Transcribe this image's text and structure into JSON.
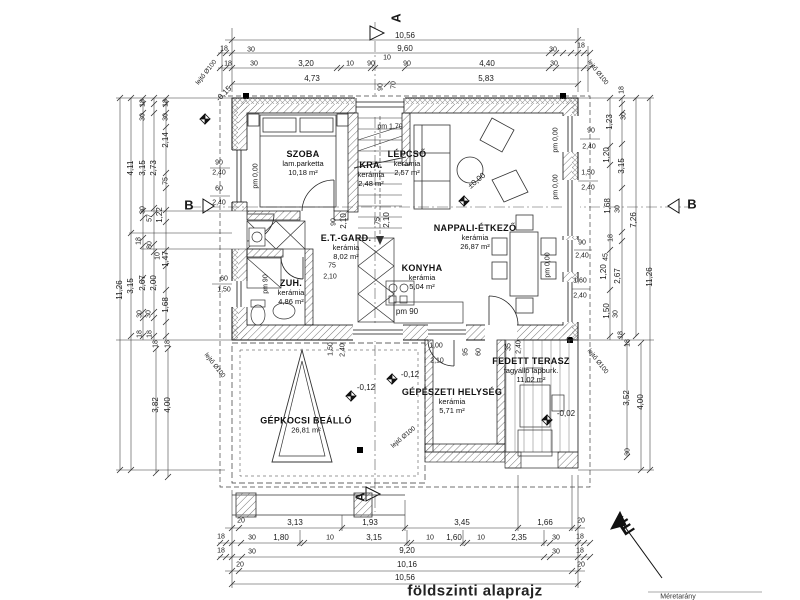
{
  "drawing": {
    "title": "földszinti alaprajz",
    "scale_note": "Méretarány",
    "north_label": "É"
  },
  "rooms": [
    {
      "name": "SZOBA",
      "finish": "lam.parketta",
      "area": "10,18 m²",
      "x": 303,
      "y": 163
    },
    {
      "name": "KRA.",
      "finish": "kerámia",
      "area": "2,48 m²",
      "x": 371,
      "y": 174
    },
    {
      "name": "LÉPCSŐ",
      "finish": "kerámia",
      "area": "2,57 m²",
      "x": 407,
      "y": 163
    },
    {
      "name": "NAPPALI-ÉTKEZŐ",
      "finish": "kerámia",
      "area": "26,87 m²",
      "x": 475,
      "y": 237
    },
    {
      "name": "E.T.-GARD.",
      "finish": "kerámia",
      "area": "8,02 m²",
      "x": 346,
      "y": 247
    },
    {
      "name": "KONYHA",
      "finish": "kerámia",
      "area": "5,04 m²",
      "x": 422,
      "y": 277
    },
    {
      "name": "ZUH.",
      "finish": "kerámia",
      "area": "4,86 m²",
      "x": 291,
      "y": 292
    },
    {
      "name": "GÉPÉSZETI HELYSÉG",
      "finish": "kerámia",
      "area": "5,71 m²",
      "x": 452,
      "y": 401
    },
    {
      "name": "FEDETT TERASZ",
      "finish": "fagyálló lapburk.",
      "area": "11,02 m²",
      "x": 531,
      "y": 370
    },
    {
      "name": "GÉPKOCSI BEÁLLÓ",
      "finish": "",
      "area": "26,81 m²",
      "x": 306,
      "y": 425
    }
  ],
  "labels": [
    {
      "n": "dim-top",
      "t": "10,56",
      "x": 405,
      "y": 36
    },
    {
      "n": "dim-top",
      "t": "18",
      "x": 224,
      "y": 49,
      "s": 7
    },
    {
      "n": "dim-top",
      "t": "30",
      "x": 251,
      "y": 50,
      "s": 7
    },
    {
      "n": "dim-top",
      "t": "9,60",
      "x": 405,
      "y": 49
    },
    {
      "n": "dim-top",
      "t": "10",
      "x": 387,
      "y": 58,
      "s": 7
    },
    {
      "n": "dim-top",
      "t": "30",
      "x": 553,
      "y": 50,
      "s": 7
    },
    {
      "n": "dim-top",
      "t": "18",
      "x": 581,
      "y": 46,
      "s": 7
    },
    {
      "n": "dim-top",
      "t": "18",
      "x": 228,
      "y": 64,
      "s": 7
    },
    {
      "n": "dim-top",
      "t": "30",
      "x": 254,
      "y": 64,
      "s": 7
    },
    {
      "n": "dim-top",
      "t": "3,20",
      "x": 306,
      "y": 64
    },
    {
      "n": "dim-top",
      "t": "10",
      "x": 350,
      "y": 64,
      "s": 7
    },
    {
      "n": "dim-top",
      "t": "90",
      "x": 371,
      "y": 64,
      "s": 7
    },
    {
      "n": "dim-top",
      "t": "90",
      "x": 407,
      "y": 64,
      "s": 7
    },
    {
      "n": "dim-top",
      "t": "4,40",
      "x": 487,
      "y": 64
    },
    {
      "n": "dim-top",
      "t": "30",
      "x": 554,
      "y": 64,
      "s": 7
    },
    {
      "n": "dim-top",
      "t": "4,73",
      "x": 312,
      "y": 79
    },
    {
      "n": "dim-top",
      "t": "5,83",
      "x": 486,
      "y": 79
    },
    {
      "n": "dim-top",
      "t": "90",
      "x": 381,
      "y": 87,
      "r": -90,
      "s": 7
    },
    {
      "n": "dim-top",
      "t": "70",
      "x": 394,
      "y": 85,
      "r": -90,
      "s": 7
    },
    {
      "n": "dim-left",
      "t": "11,26",
      "x": 120,
      "y": 290,
      "r": -90
    },
    {
      "n": "dim-left",
      "t": "4,11",
      "x": 131,
      "y": 168,
      "r": -90
    },
    {
      "n": "dim-left",
      "t": "3,15",
      "x": 143,
      "y": 168,
      "r": -90
    },
    {
      "n": "dim-left",
      "t": "2,73",
      "x": 154,
      "y": 168,
      "r": -90
    },
    {
      "n": "dim-left",
      "t": "2,14",
      "x": 166,
      "y": 140,
      "r": -90
    },
    {
      "n": "dim-left",
      "t": "18",
      "x": 143,
      "y": 103,
      "r": -90,
      "s": 7
    },
    {
      "n": "dim-left",
      "t": "18",
      "x": 166,
      "y": 103,
      "r": -90,
      "s": 7
    },
    {
      "n": "dim-left",
      "t": "30",
      "x": 143,
      "y": 117,
      "r": -90,
      "s": 7
    },
    {
      "n": "dim-left",
      "t": "30",
      "x": 166,
      "y": 117,
      "r": -90,
      "s": 7
    },
    {
      "n": "dim-left",
      "t": "75",
      "x": 166,
      "y": 181,
      "r": -90,
      "s": 7
    },
    {
      "n": "dim-left",
      "t": "30",
      "x": 143,
      "y": 210,
      "r": -90,
      "s": 7
    },
    {
      "n": "dim-left",
      "t": "1,22",
      "x": 160,
      "y": 215,
      "r": -90
    },
    {
      "n": "dim-left",
      "t": "57",
      "x": 150,
      "y": 218,
      "r": -90,
      "s": 7
    },
    {
      "n": "dim-left",
      "t": "18",
      "x": 139,
      "y": 241,
      "r": -90,
      "s": 7
    },
    {
      "n": "dim-left",
      "t": "80",
      "x": 150,
      "y": 245,
      "r": -90,
      "s": 7
    },
    {
      "n": "dim-left",
      "t": "10",
      "x": 158,
      "y": 256,
      "r": -90,
      "s": 7
    },
    {
      "n": "dim-left",
      "t": "1,47",
      "x": 166,
      "y": 259,
      "r": -90
    },
    {
      "n": "dim-left",
      "t": "3,15",
      "x": 131,
      "y": 286,
      "r": -90
    },
    {
      "n": "dim-left",
      "t": "2,67",
      "x": 143,
      "y": 283,
      "r": -90
    },
    {
      "n": "dim-left",
      "t": "2,00",
      "x": 154,
      "y": 283,
      "r": -90
    },
    {
      "n": "dim-left",
      "t": "1,68",
      "x": 166,
      "y": 305,
      "r": -90
    },
    {
      "n": "dim-left",
      "t": "30",
      "x": 140,
      "y": 314,
      "r": -90,
      "s": 7
    },
    {
      "n": "dim-left",
      "t": "30",
      "x": 149,
      "y": 314,
      "r": -90,
      "s": 7
    },
    {
      "n": "dim-left",
      "t": "18",
      "x": 140,
      "y": 334,
      "r": -90,
      "s": 7
    },
    {
      "n": "dim-left",
      "t": "18",
      "x": 150,
      "y": 334,
      "r": -90,
      "s": 7
    },
    {
      "n": "dim-left",
      "t": "18",
      "x": 156,
      "y": 344,
      "r": -90,
      "s": 7
    },
    {
      "n": "dim-left",
      "t": "18",
      "x": 168,
      "y": 344,
      "r": -90,
      "s": 7
    },
    {
      "n": "dim-left",
      "t": "3,82",
      "x": 156,
      "y": 405,
      "r": -90
    },
    {
      "n": "dim-left",
      "t": "4,00",
      "x": 168,
      "y": 405,
      "r": -90
    },
    {
      "n": "dim-window",
      "t": "90",
      "x": 219,
      "y": 163,
      "s": 7
    },
    {
      "n": "dim-window",
      "t": "2,40",
      "x": 219,
      "y": 173,
      "s": 7
    },
    {
      "n": "dim-window",
      "t": "60",
      "x": 219,
      "y": 189,
      "s": 7
    },
    {
      "n": "dim-window",
      "t": "2,40",
      "x": 219,
      "y": 203,
      "s": 7
    },
    {
      "n": "dim-window",
      "t": "60",
      "x": 224,
      "y": 279,
      "s": 7
    },
    {
      "n": "dim-window",
      "t": "1,50",
      "x": 224,
      "y": 290,
      "s": 7
    },
    {
      "n": "level-minus-0-15",
      "t": "-0,15",
      "x": 224,
      "y": 94,
      "r": -45
    },
    {
      "n": "dim-right",
      "t": "18",
      "x": 622,
      "y": 90,
      "r": -90,
      "s": 7
    },
    {
      "n": "dim-right",
      "t": "30",
      "x": 624,
      "y": 116,
      "r": -90,
      "s": 7
    },
    {
      "n": "dim-right",
      "t": "1,23",
      "x": 610,
      "y": 122,
      "r": -90
    },
    {
      "n": "dim-right",
      "t": "1,20",
      "x": 607,
      "y": 155,
      "r": -90
    },
    {
      "n": "dim-right",
      "t": "3,15",
      "x": 622,
      "y": 166,
      "r": -90
    },
    {
      "n": "dim-right",
      "t": "1,68",
      "x": 608,
      "y": 206,
      "r": -90
    },
    {
      "n": "dim-right",
      "t": "30",
      "x": 618,
      "y": 209,
      "r": -90,
      "s": 7
    },
    {
      "n": "dim-right",
      "t": "7,26",
      "x": 634,
      "y": 220,
      "r": -90
    },
    {
      "n": "dim-right",
      "t": "18",
      "x": 611,
      "y": 238,
      "r": -90,
      "s": 7
    },
    {
      "n": "dim-right",
      "t": "45",
      "x": 606,
      "y": 257,
      "r": -90,
      "s": 7
    },
    {
      "n": "dim-right",
      "t": "1,20",
      "x": 604,
      "y": 272,
      "r": -90
    },
    {
      "n": "dim-right",
      "t": "2,67",
      "x": 618,
      "y": 276,
      "r": -90
    },
    {
      "n": "dim-right",
      "t": "11,26",
      "x": 650,
      "y": 277,
      "r": -90
    },
    {
      "n": "dim-right",
      "t": "1,50",
      "x": 607,
      "y": 311,
      "r": -90
    },
    {
      "n": "dim-right",
      "t": "30",
      "x": 616,
      "y": 314,
      "r": -90,
      "s": 7
    },
    {
      "n": "dim-right",
      "t": "18",
      "x": 621,
      "y": 335,
      "r": -90,
      "s": 7
    },
    {
      "n": "dim-right",
      "t": "18",
      "x": 628,
      "y": 343,
      "r": -90,
      "s": 7
    },
    {
      "n": "dim-right",
      "t": "3,52",
      "x": 627,
      "y": 398,
      "r": -90
    },
    {
      "n": "dim-right",
      "t": "4,00",
      "x": 641,
      "y": 402,
      "r": -90
    },
    {
      "n": "dim-right",
      "t": "30",
      "x": 628,
      "y": 452,
      "r": -90,
      "s": 7
    },
    {
      "n": "dim-window",
      "t": "90",
      "x": 591,
      "y": 131,
      "s": 7
    },
    {
      "n": "dim-window",
      "t": "2,40",
      "x": 589,
      "y": 147,
      "s": 7
    },
    {
      "n": "dim-window",
      "t": "1,50",
      "x": 588,
      "y": 173,
      "s": 7
    },
    {
      "n": "dim-window",
      "t": "2,40",
      "x": 588,
      "y": 188,
      "s": 7
    },
    {
      "n": "dim-window",
      "t": "90",
      "x": 582,
      "y": 243,
      "s": 7
    },
    {
      "n": "dim-window",
      "t": "2,40",
      "x": 582,
      "y": 256,
      "s": 7
    },
    {
      "n": "dim-window",
      "t": "1,60",
      "x": 580,
      "y": 281,
      "s": 7
    },
    {
      "n": "dim-window",
      "t": "2,40",
      "x": 580,
      "y": 296,
      "s": 7
    },
    {
      "n": "dim-bottom",
      "t": "20",
      "x": 241,
      "y": 521,
      "s": 7
    },
    {
      "n": "dim-bottom",
      "t": "3,13",
      "x": 295,
      "y": 523
    },
    {
      "n": "dim-bottom",
      "t": "1,93",
      "x": 370,
      "y": 523
    },
    {
      "n": "dim-bottom",
      "t": "3,45",
      "x": 462,
      "y": 523
    },
    {
      "n": "dim-bottom",
      "t": "1,66",
      "x": 545,
      "y": 523
    },
    {
      "n": "dim-bottom",
      "t": "20",
      "x": 581,
      "y": 521,
      "s": 7
    },
    {
      "n": "dim-bottom",
      "t": "18",
      "x": 221,
      "y": 537,
      "s": 7
    },
    {
      "n": "dim-bottom",
      "t": "30",
      "x": 252,
      "y": 538,
      "s": 7
    },
    {
      "n": "dim-bottom",
      "t": "1,80",
      "x": 281,
      "y": 538
    },
    {
      "n": "dim-bottom",
      "t": "10",
      "x": 330,
      "y": 538,
      "s": 7
    },
    {
      "n": "dim-bottom",
      "t": "3,15",
      "x": 374,
      "y": 538
    },
    {
      "n": "dim-bottom",
      "t": "10",
      "x": 430,
      "y": 538,
      "s": 7
    },
    {
      "n": "dim-bottom",
      "t": "1,60",
      "x": 454,
      "y": 538
    },
    {
      "n": "dim-bottom",
      "t": "10",
      "x": 481,
      "y": 538,
      "s": 7
    },
    {
      "n": "dim-bottom",
      "t": "2,35",
      "x": 519,
      "y": 538
    },
    {
      "n": "dim-bottom",
      "t": "30",
      "x": 556,
      "y": 538,
      "s": 7
    },
    {
      "n": "dim-bottom",
      "t": "18",
      "x": 580,
      "y": 537,
      "s": 7
    },
    {
      "n": "dim-bottom",
      "t": "18",
      "x": 221,
      "y": 551,
      "s": 7
    },
    {
      "n": "dim-bottom",
      "t": "30",
      "x": 252,
      "y": 552,
      "s": 7
    },
    {
      "n": "dim-bottom",
      "t": "9,20",
      "x": 407,
      "y": 551
    },
    {
      "n": "dim-bottom",
      "t": "30",
      "x": 556,
      "y": 552,
      "s": 7
    },
    {
      "n": "dim-bottom",
      "t": "18",
      "x": 580,
      "y": 551,
      "s": 7
    },
    {
      "n": "dim-bottom",
      "t": "20",
      "x": 240,
      "y": 565,
      "s": 7
    },
    {
      "n": "dim-bottom",
      "t": "10,16",
      "x": 407,
      "y": 565
    },
    {
      "n": "dim-bottom",
      "t": "20",
      "x": 581,
      "y": 565,
      "s": 7
    },
    {
      "n": "dim-bottom",
      "t": "10,56",
      "x": 405,
      "y": 578
    },
    {
      "n": "dim-door",
      "t": "90",
      "x": 334,
      "y": 222,
      "r": -90,
      "s": 7
    },
    {
      "n": "dim-door",
      "t": "2,10",
      "x": 344,
      "y": 221,
      "r": -90
    },
    {
      "n": "dim-door",
      "t": "75",
      "x": 378,
      "y": 221,
      "r": -90,
      "s": 7
    },
    {
      "n": "dim-door",
      "t": "2,10",
      "x": 387,
      "y": 220,
      "r": -90
    },
    {
      "n": "parapet-note",
      "t": "pm 1,70",
      "x": 390,
      "y": 127,
      "s": 7
    },
    {
      "n": "dim-door",
      "t": "75",
      "x": 332,
      "y": 266,
      "s": 7
    },
    {
      "n": "dim-door",
      "t": "2,10",
      "x": 330,
      "y": 277,
      "s": 7
    },
    {
      "n": "parapet-note",
      "t": "pm 90",
      "x": 407,
      "y": 312,
      "s": 8
    },
    {
      "n": "parapet-note",
      "t": "pm 90",
      "x": 266,
      "y": 284,
      "r": -90,
      "s": 7
    },
    {
      "n": "parapet-note",
      "t": "pm 0,00",
      "x": 256,
      "y": 176,
      "r": -90,
      "s": 7
    },
    {
      "n": "parapet-note",
      "t": "pm 0,00",
      "x": 556,
      "y": 140,
      "r": -90,
      "s": 7
    },
    {
      "n": "parapet-note",
      "t": "pm 0,00",
      "x": 556,
      "y": 187,
      "r": -90,
      "s": 7
    },
    {
      "n": "parapet-note",
      "t": "pm 0,00",
      "x": 548,
      "y": 265,
      "r": -90,
      "s": 7
    },
    {
      "n": "dim-door",
      "t": "1,50",
      "x": 331,
      "y": 349,
      "r": -90,
      "s": 7
    },
    {
      "n": "dim-door",
      "t": "2,40",
      "x": 343,
      "y": 350,
      "r": -90,
      "s": 7
    },
    {
      "n": "dim-door",
      "t": "95",
      "x": 466,
      "y": 352,
      "r": -90,
      "s": 7
    },
    {
      "n": "dim-door",
      "t": "60",
      "x": 479,
      "y": 352,
      "r": -90,
      "s": 7
    },
    {
      "n": "dim-door",
      "t": "1,00",
      "x": 436,
      "y": 346,
      "s": 7
    },
    {
      "n": "dim-door",
      "t": "2,10",
      "x": 437,
      "y": 361,
      "s": 7
    },
    {
      "n": "dim-door",
      "t": "35",
      "x": 509,
      "y": 347,
      "r": -90,
      "s": 7
    },
    {
      "n": "dim-door",
      "t": "2,40",
      "x": 519,
      "y": 347,
      "r": -90,
      "s": 7
    },
    {
      "n": "level-plusminus-0-00",
      "t": "±0,00",
      "x": 477,
      "y": 181,
      "r": -40
    },
    {
      "n": "level-minus-0-12",
      "t": "-0,12",
      "x": 366,
      "y": 388
    },
    {
      "n": "level-minus-0-12",
      "t": "-0,12",
      "x": 410,
      "y": 375
    },
    {
      "n": "level-minus-0-02",
      "t": "-0,02",
      "x": 566,
      "y": 414
    },
    {
      "n": "slope-note",
      "t": "lejtő Ø100",
      "x": 207,
      "y": 73,
      "r": -52,
      "s": 6.5
    },
    {
      "n": "slope-note",
      "t": "lejtő Ø100",
      "x": 597,
      "y": 73,
      "r": 52,
      "s": 6.5
    },
    {
      "n": "slope-note",
      "t": "lejtő Ø100",
      "x": 597,
      "y": 362,
      "r": 52,
      "s": 6.5
    },
    {
      "n": "slope-note",
      "t": "lejtő Ø100",
      "x": 404,
      "y": 438,
      "r": -40,
      "s": 6.5
    },
    {
      "n": "slope-note",
      "t": "lejtő Ø100",
      "x": 214,
      "y": 366,
      "r": 52,
      "s": 6.5
    },
    {
      "n": "section-letter-a",
      "t": "A",
      "x": 396,
      "y": 18,
      "r": -90,
      "s": 13,
      "b": 1
    },
    {
      "n": "section-letter-a",
      "t": "A",
      "x": 360,
      "y": 497,
      "r": -90,
      "s": 13,
      "b": 1
    },
    {
      "n": "section-letter-b",
      "t": "B",
      "x": 189,
      "y": 205,
      "s": 13,
      "b": 1
    },
    {
      "n": "section-letter-b",
      "t": "B",
      "x": 692,
      "y": 204,
      "s": 13,
      "b": 1
    }
  ]
}
